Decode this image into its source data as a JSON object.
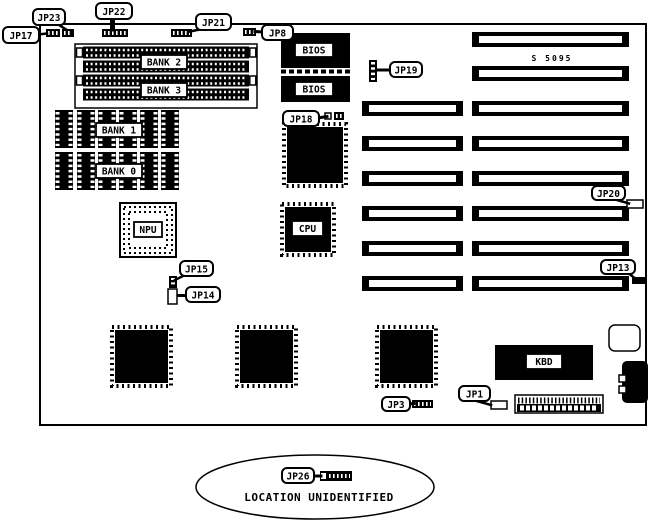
{
  "diagram": {
    "board_id": "S 5095",
    "note": "LOCATION UNIDENTIFIED",
    "ink_color": "#000000",
    "paper_color": "#ffffff"
  },
  "chips": {
    "bank2": "BANK 2",
    "bank3": "BANK 3",
    "bank1": "BANK 1",
    "bank0": "BANK 0",
    "bios_top": "BIOS",
    "bios_bottom": "BIOS",
    "npu": "NPU",
    "cpu": "CPU",
    "kbd": "KBD"
  },
  "jumpers": {
    "jp17": "JP17",
    "jp23": "JP23",
    "jp22": "JP22",
    "jp21": "JP21",
    "jp8": "JP8",
    "jp19": "JP19",
    "jp18": "JP18",
    "jp20": "JP20",
    "jp13": "JP13",
    "jp15": "JP15",
    "jp14": "JP14",
    "jp1": "JP1",
    "jp3": "JP3",
    "jp26": "JP26"
  }
}
